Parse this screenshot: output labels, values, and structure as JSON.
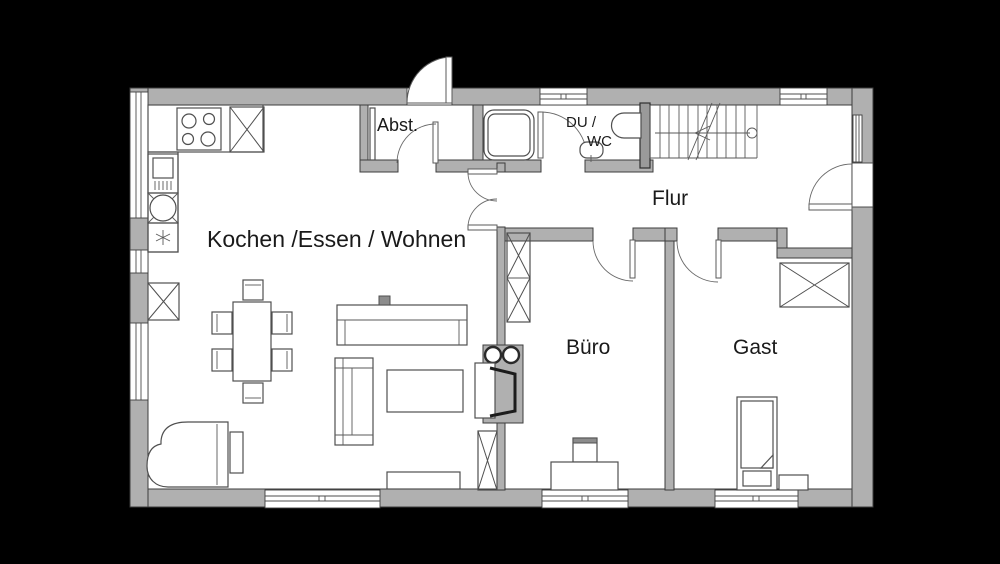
{
  "plan": {
    "type": "floor-plan",
    "rooms": {
      "kitchen_living": {
        "label": "Kochen /Essen / Wohnen"
      },
      "storage": {
        "label": "Abst."
      },
      "shower_wc": {
        "label_line1": "DU /",
        "label_line2": "WC"
      },
      "hall": {
        "label": "Flur"
      },
      "office": {
        "label": "Büro"
      },
      "guest": {
        "label": "Gast"
      }
    },
    "colors": {
      "background": "#000000",
      "floor": "#ffffff",
      "wall_fill": "#b0b0b0",
      "wall_stroke": "#3d3d3d",
      "furniture_stroke": "#4f4f4f",
      "text": "#1a1a1a"
    }
  }
}
